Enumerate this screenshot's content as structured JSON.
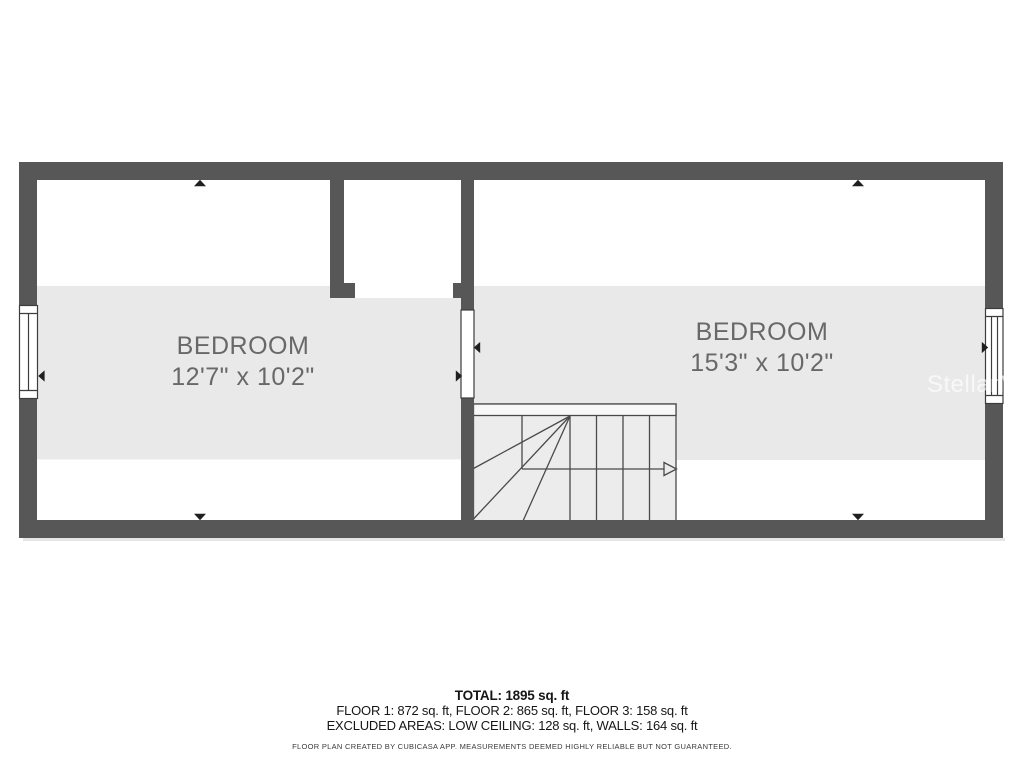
{
  "page": {
    "background": "#ffffff",
    "type": "floor-plan"
  },
  "floor_plan": {
    "wall_color": "#575757",
    "room_fill": "#ffffff",
    "highlight_band_color": "#e9e9e9",
    "stair_fill": "#ececec",
    "outline_color": "#4a4a4a",
    "dimension_marker_color": "#1f1f1f",
    "rooms": [
      {
        "id": "bedroom-left",
        "label": "BEDROOM",
        "dimensions": "12'7\" x 10'2\""
      },
      {
        "id": "bedroom-right",
        "label": "BEDROOM",
        "dimensions": "15'3\" x 10'2\""
      }
    ],
    "icons": [
      {
        "name": "window-icon",
        "count": 3
      },
      {
        "name": "dimension-arrow-icon",
        "count": 8
      },
      {
        "name": "stair-direction-arrow-icon",
        "count": 1
      }
    ]
  },
  "footer": {
    "total": "TOTAL: 1895 sq. ft",
    "floor_breakdown": "FLOOR 1: 872 sq. ft, FLOOR 2: 865 sq. ft, FLOOR 3: 158 sq. ft",
    "excluded_areas": "EXCLUDED AREAS: LOW CEILING: 128 sq. ft, WALLS: 164 sq. ft",
    "disclaimer": "FLOOR PLAN CREATED BY CUBICASA APP. MEASUREMENTS DEEMED HIGHLY RELIABLE BUT NOT GUARANTEED."
  },
  "watermark": {
    "text": "StellarMLS",
    "color": "rgba(255,255,255,0.68)"
  }
}
